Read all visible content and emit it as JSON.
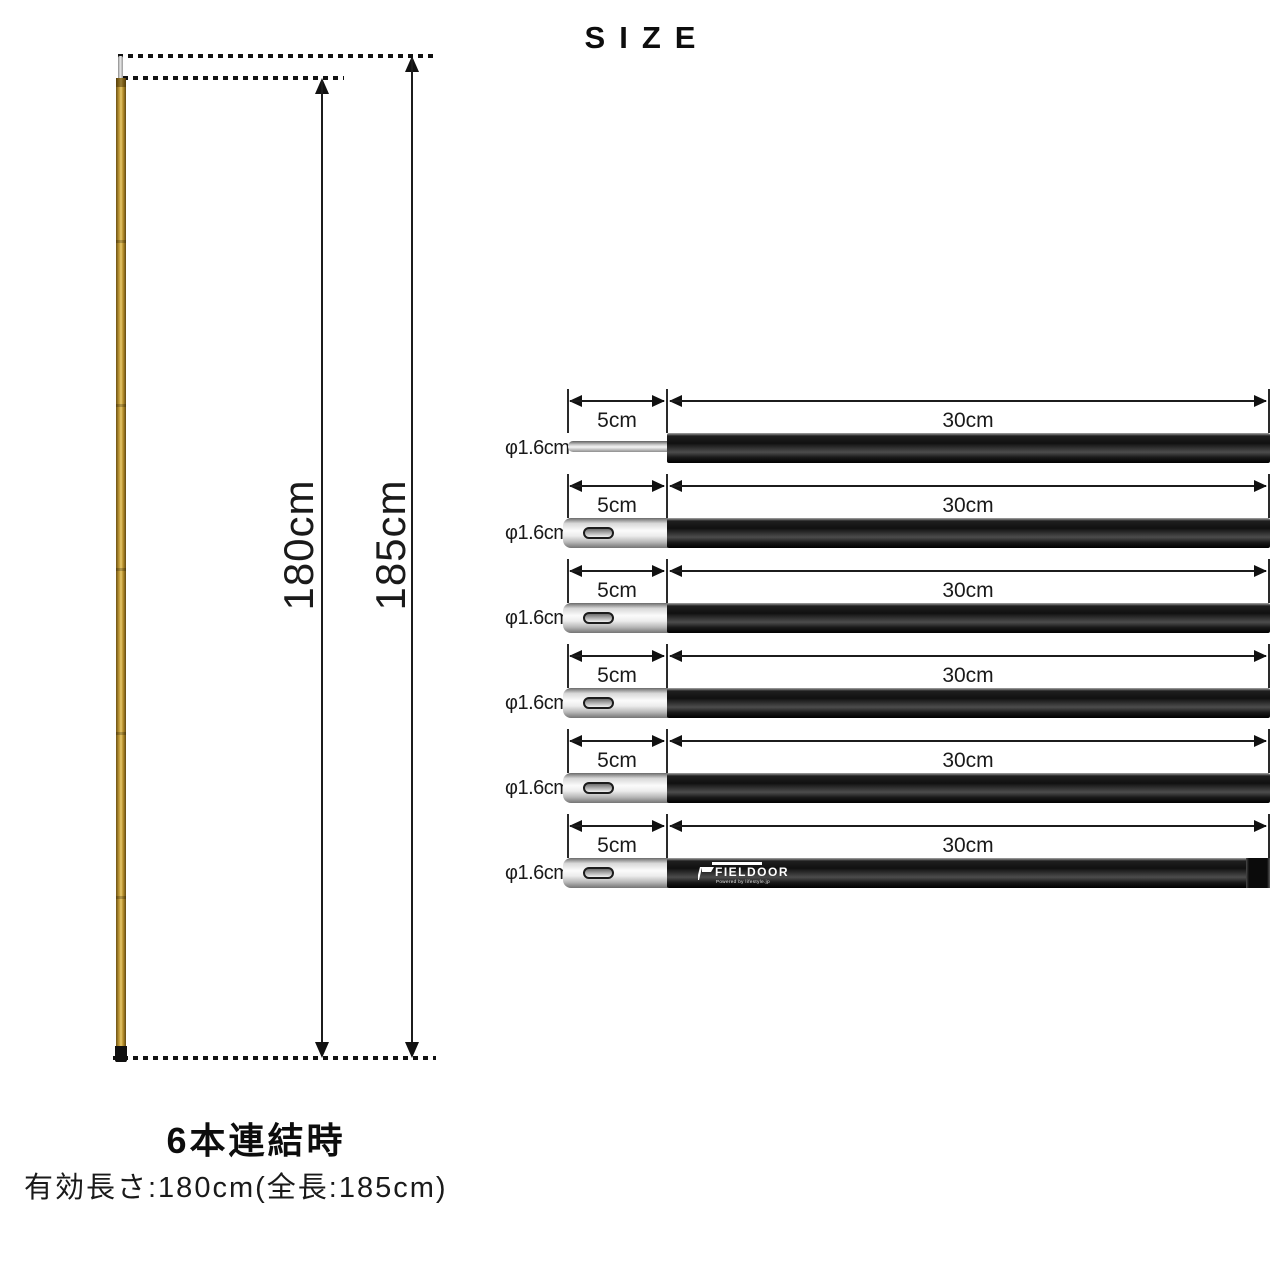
{
  "title": "SIZE",
  "assembled": {
    "effective_length": "180cm",
    "total_length": "185cm",
    "caption_title": "6本連結時",
    "caption_detail": "有効長さ:180cm(全長:185cm)"
  },
  "segments": [
    {
      "diameter": "φ1.6cm",
      "connector_length": "5cm",
      "body_length": "30cm",
      "connector_type": "spigot-pin"
    },
    {
      "diameter": "φ1.6cm",
      "connector_length": "5cm",
      "body_length": "30cm",
      "connector_type": "sleeve"
    },
    {
      "diameter": "φ1.6cm",
      "connector_length": "5cm",
      "body_length": "30cm",
      "connector_type": "sleeve"
    },
    {
      "diameter": "φ1.6cm",
      "connector_length": "5cm",
      "body_length": "30cm",
      "connector_type": "sleeve"
    },
    {
      "diameter": "φ1.6cm",
      "connector_length": "5cm",
      "body_length": "30cm",
      "connector_type": "sleeve"
    },
    {
      "diameter": "φ1.6cm",
      "connector_length": "5cm",
      "body_length": "30cm",
      "connector_type": "sleeve",
      "logo": "FIELDOOR",
      "logo_sub": "Powered by lifestyle.jp"
    }
  ],
  "colors": {
    "pole_gold": "#c9a23c",
    "pole_black": "#141414",
    "connector_silver": "#d8d8d8",
    "line": "#111111",
    "background": "#ffffff"
  }
}
